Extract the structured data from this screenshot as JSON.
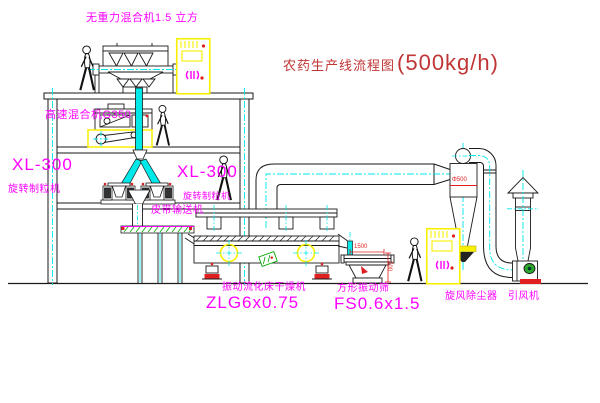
{
  "title": {
    "name": "农药生产线流程图",
    "capacity": "(500kg/h)"
  },
  "labels": {
    "gravity_mixer": "无重力混合机1.5 立方",
    "high_speed_mixer": "高速混合机G350",
    "xl300_left": "XL-300",
    "granulator_left": "旋转制粒机",
    "xl300_right": "XL-300",
    "granulator_right": "旋转制粒机",
    "belt_conveyor": "皮带输送机",
    "dryer_name": "振动流化床干燥机",
    "dryer_model": "ZLG6x0.75",
    "sieve_name": "方形振动筛",
    "sieve_model": "FS0.6x1.5",
    "cyclone_name": "旋风除尘器",
    "fan_name": "引风机"
  },
  "dimensions": {
    "cyclone_diameter": "Φ500",
    "sieve_length": "1500",
    "sieve_height": "500"
  },
  "colors": {
    "label_magenta": "#ff00ff",
    "title_red": "#c03535",
    "dimension_red": "#e02020",
    "centerline_cyan": "#00e8e8",
    "highlight_yellow": "#f8f000",
    "hatch_green": "#00aa00",
    "line_black": "#1a1a1a"
  }
}
